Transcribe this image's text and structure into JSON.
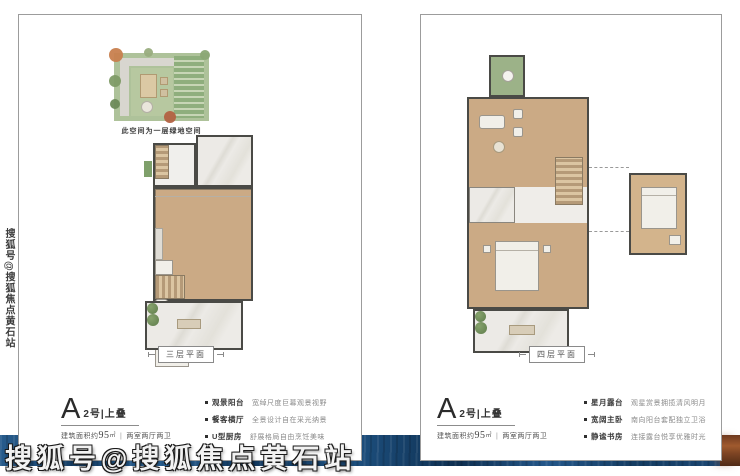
{
  "watermark": {
    "text": "搜狐号@搜狐焦点黄石站"
  },
  "left_card": {
    "garden_caption": "此空间为一层绿地空间",
    "plan_label": "三层平面",
    "unit": {
      "letter": "A",
      "suffix": "2号|上叠"
    },
    "area": {
      "prefix": "建筑面积约",
      "value": "95",
      "unit": "㎡",
      "divider": "|",
      "rooms": "两室两厅两卫"
    },
    "features": [
      {
        "name": "观景阳台",
        "desc": "宽绰尺度巨幕观景视野"
      },
      {
        "name": "餐客横厅",
        "desc": "全景设计自在采光纳景"
      },
      {
        "name": "U型厨房",
        "desc": "舒展格局自由烹饪美味"
      }
    ]
  },
  "right_card": {
    "plan_label": "四层平面",
    "unit": {
      "letter": "A",
      "suffix": "2号|上叠"
    },
    "area": {
      "prefix": "建筑面积约",
      "value": "95",
      "unit": "㎡",
      "divider": "|",
      "rooms": "两室两厅两卫"
    },
    "features": [
      {
        "name": "星月露台",
        "desc": "观星赏景拥揽清风明月"
      },
      {
        "name": "宽阔主卧",
        "desc": "南向阳台套配独立卫浴"
      },
      {
        "name": "静谧书房",
        "desc": "连接露台悦享优雅时光"
      }
    ]
  },
  "colors": {
    "band_blue": "#1d4a77",
    "band_brown": "#7d4423",
    "card_border": "#9c9c9c"
  }
}
